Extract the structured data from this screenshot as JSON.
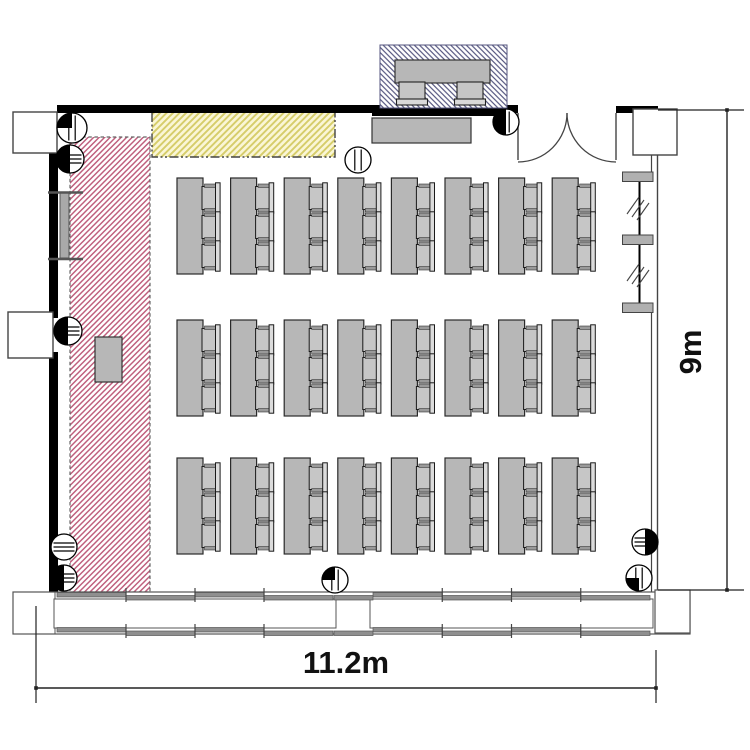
{
  "drawing": {
    "type": "architectural floor plan",
    "room": "seminar / classroom layout plan"
  },
  "dimensions": {
    "width_label": "11.2m",
    "height_label": "9m"
  },
  "zones": {
    "screen_zone": {
      "label": "projection / screen zone (red hatch)",
      "stripe_color": "#bf5f7d",
      "bg": "#ffffff"
    },
    "whiteboard_zone": {
      "label": "whiteboard zone (yellow hatch)",
      "stripe_color": "#d6cd6a",
      "bg": "#faf6d6"
    },
    "presenter_zone": {
      "label": "presenter desk zone (blue hatch)",
      "stripe_color": "#55567f",
      "bg": "#ffffff"
    }
  },
  "furniture": {
    "table_fill": "#b7b7b7",
    "table_grid": {
      "columns": 8,
      "row_groups": 3,
      "chairs_per_table": 3,
      "col_start_x": 177,
      "col_spacing": 53.6,
      "group_y": [
        178,
        320,
        458
      ],
      "table_w": 26,
      "table_h": 96
    },
    "total_tables": 24,
    "total_chairs": 72,
    "presenter_desk_chairs": 2
  },
  "floor_markers": [
    {
      "cx": 72,
      "cy": 128,
      "r": 15,
      "lines": "v",
      "solid": "tl"
    },
    {
      "cx": 70,
      "cy": 159,
      "r": 14,
      "lines": "h",
      "solid": "l"
    },
    {
      "cx": 68,
      "cy": 331,
      "r": 14,
      "lines": "h",
      "solid": "l"
    },
    {
      "cx": 64,
      "cy": 547,
      "r": 13,
      "lines": "h",
      "solid": "none"
    },
    {
      "cx": 64,
      "cy": 578,
      "r": 13,
      "lines": "h",
      "solid": "l"
    },
    {
      "cx": 358,
      "cy": 160,
      "r": 13,
      "lines": "v",
      "solid": "none"
    },
    {
      "cx": 506,
      "cy": 122,
      "r": 13,
      "lines": "v",
      "solid": "l"
    },
    {
      "cx": 335,
      "cy": 580,
      "r": 13,
      "lines": "v",
      "solid": "tl"
    },
    {
      "cx": 645,
      "cy": 542,
      "r": 13,
      "lines": "h",
      "solid": "r"
    },
    {
      "cx": 639,
      "cy": 578,
      "r": 13,
      "lines": "v",
      "solid": "bl"
    }
  ],
  "windows": {
    "bottom_units": [
      {
        "x": 57,
        "w": 276
      },
      {
        "x": 373,
        "w": 277
      }
    ],
    "segments_per_unit": 4,
    "right_window_mullions_y": [
      172,
      235,
      303
    ]
  }
}
